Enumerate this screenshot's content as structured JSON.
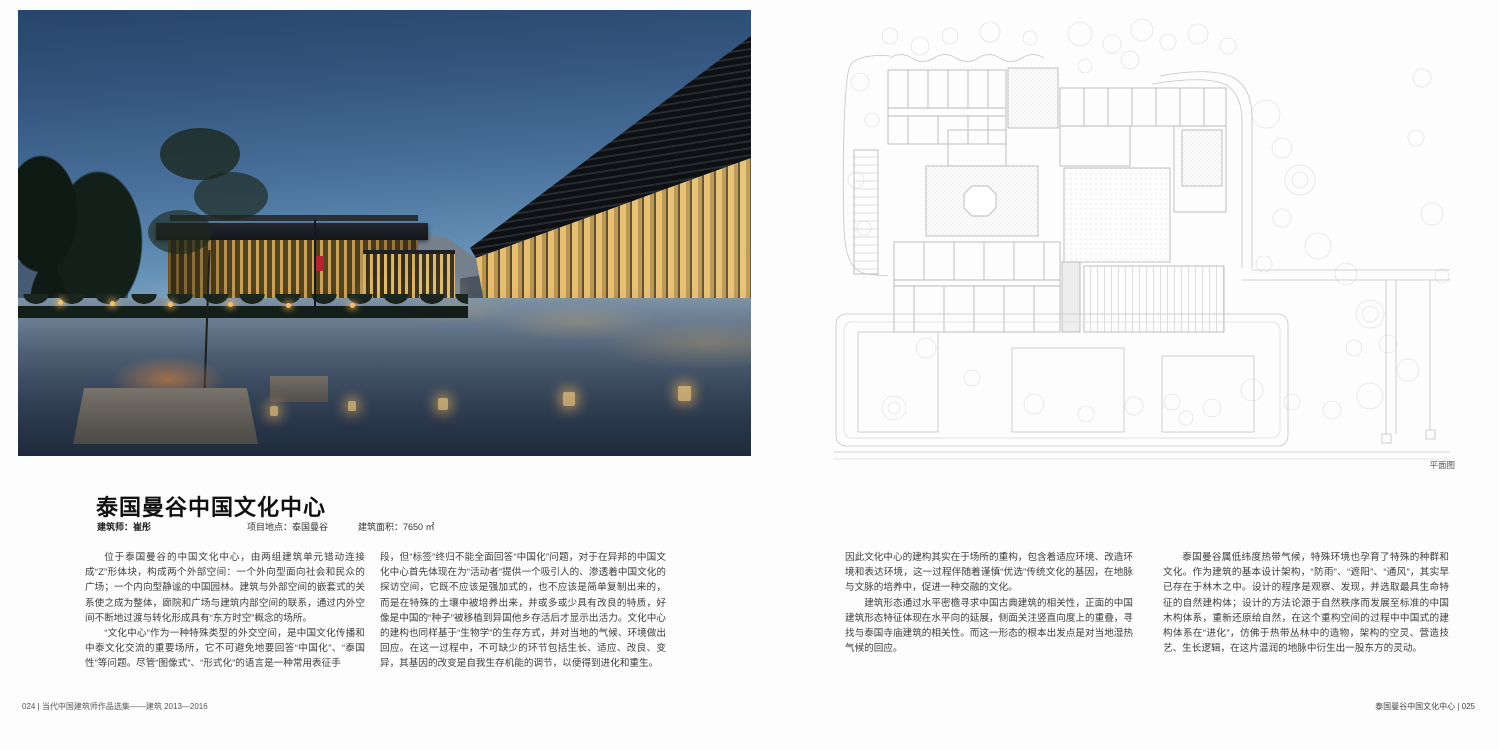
{
  "article": {
    "title": "泰国曼谷中国文化中心",
    "architect": "建筑师：崔彤",
    "location": "项目地点：泰国曼谷",
    "area": "建筑面积：7650 ㎡",
    "columns": [
      {
        "paragraphs": [
          "位于泰国曼谷的中国文化中心，由两组建筑单元错动连接成“Z”形体块，构成两个外部空间：一个外向型面向社会和民众的广场；一个内向型静谧的中国园林。建筑与外部空间的嵌套式的关系使之成为整体，廊院和广场与建筑内部空间的联系，通过内外空间不断地过渡与转化形成具有“东方时空”概念的场所。",
          "“文化中心”作为一种特殊类型的外交空间，是中国文化传播和中泰文化交流的重要场所，它不可避免地要回答“中国化”、“泰国性”等问题。尽管“图像式”、“形式化”的语言是一种常用表征手"
        ]
      },
      {
        "paragraphs": [
          "段，但“标签”终归不能全面回答“中国化”问题，对于在异邦的中国文化中心首先体现在为“活动者”提供一个吸引人的、渗透着中国文化的探访空间，它既不应该是强加式的，也不应该是简单复制出来的，而是在特殊的土壤中被培养出来，并或多或少具有改良的特质，好像是中国的“种子”被移植到异国他乡存活后才显示出活力。文化中心的建构也同样基于“生物学”的生存方式，并对当地的气候、环境做出回应。在这一过程中，不可缺少的环节包括生长、适应、改良、变异，其基因的改变是自我生存机能的调节，以便得到进化和重生。"
        ]
      },
      {
        "paragraphs": [
          "因此文化中心的建构其实在于场所的重构，包含着适应环境、改造环境和表达环境，这一过程伴随着谨慎“优选”传统文化的基因，在地脉与文脉的培养中，促进一种交融的文化。",
          "建筑形态通过水平密檐寻求中国古典建筑的相关性，正面的中国建筑形态特征体现在水平向的延展，侧面关注竖直向度上的重叠，寻找与泰国寺庙建筑的相关性。而这一形态的根本出发点是对当地湿热气候的回应。"
        ]
      },
      {
        "paragraphs": [
          "泰国曼谷属低纬度热带气候，特殊环境也孕育了特殊的种群和文化。作为建筑的基本设计架构，“防雨”、“遮阳”、“通风”，其实早已存在于林木之中。设计的程序是观察、发现，并选取最具生命特征的自然建构体；设计的方法论源于自然秩序而发展至标准的中国木构体系，重新还原给自然，在这个重构空间的过程中中国式的建构体系在“进化”，仿佛于热带丛林中的造物，架构的空灵、营造技艺、生长逻辑，在这片温润的地脉中衍生出一股东方的灵动。"
        ]
      }
    ]
  },
  "plan": {
    "caption": "平面图"
  },
  "folio": {
    "left": "024 | 当代中国建筑师作品选集——建筑 2013—2016",
    "right": "泰国曼谷中国文化中心 | 025"
  },
  "colors": {
    "sky_top": "#27456a",
    "sky_horizon": "#8db0ca",
    "warm_glow": "#e0b468",
    "plaza_dark": "#2c3a50",
    "plan_stroke": "#c4c4c4"
  }
}
